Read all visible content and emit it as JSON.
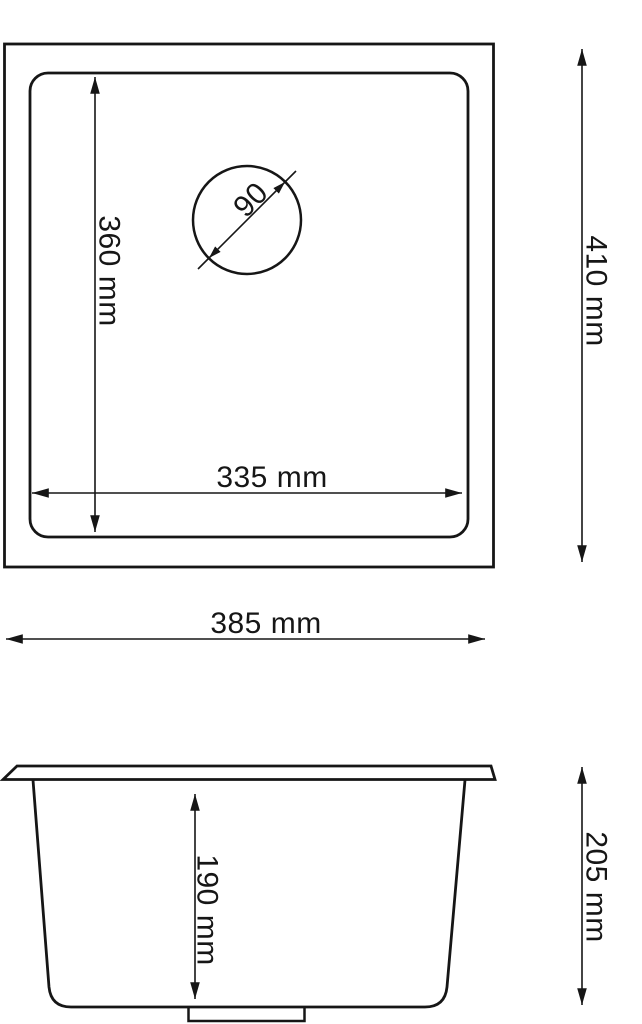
{
  "colors": {
    "ink": "#161616",
    "background": "#ffffff"
  },
  "top_view": {
    "bowl_length_label": "360 mm",
    "bowl_width_label": "335 mm",
    "overall_length_label": "410 mm",
    "drain_diameter_label": "90"
  },
  "overall_width_label": "385 mm",
  "side_view": {
    "bowl_depth_label": "190 mm",
    "overall_depth_label": "205 mm"
  }
}
